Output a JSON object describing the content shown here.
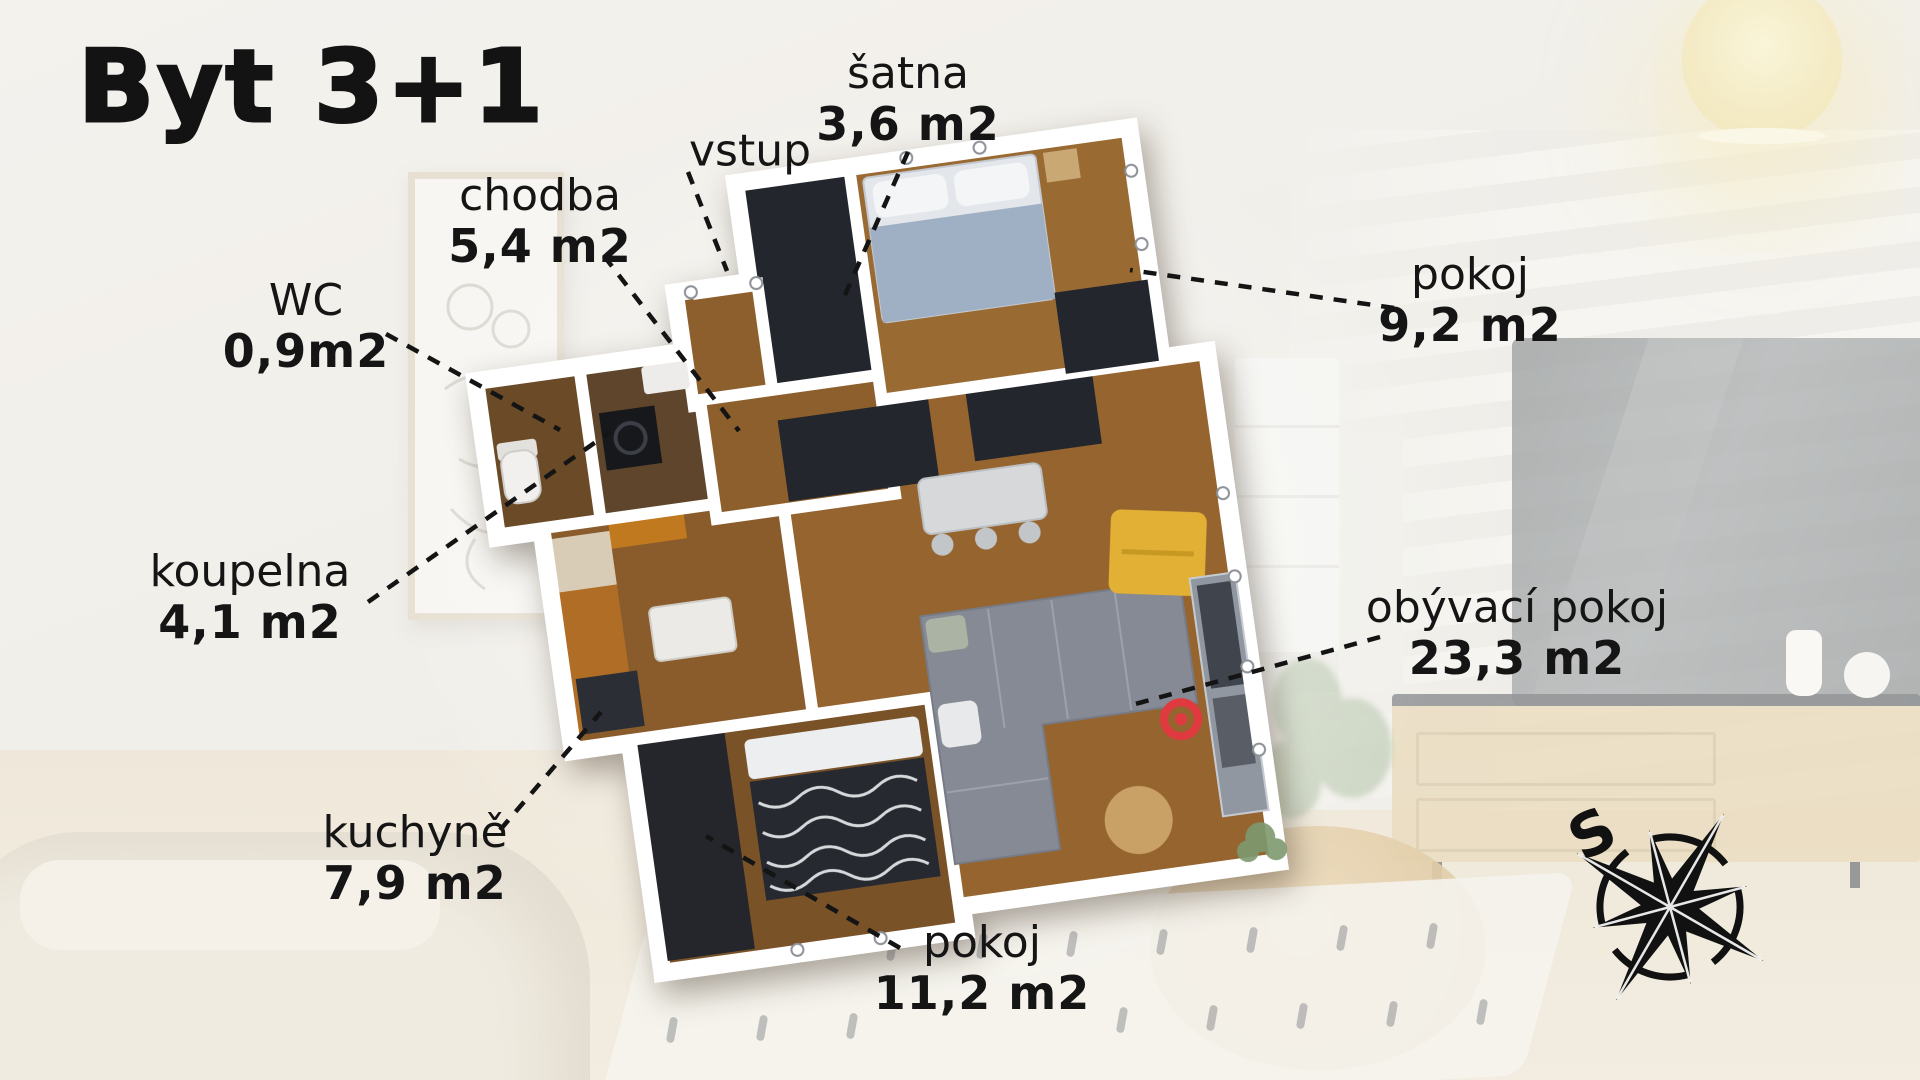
{
  "title": "Byt 3+1",
  "compass": {
    "north_letter": "S"
  },
  "rooms": [
    {
      "name": "šatna",
      "area": "3,6 m2"
    },
    {
      "name": "vstup",
      "area": ""
    },
    {
      "name": "chodba",
      "area": "5,4 m2"
    },
    {
      "name": "WC",
      "area": "0,9m2"
    },
    {
      "name": "pokoj",
      "area": "9,2 m2"
    },
    {
      "name": "koupelna",
      "area": "4,1 m2"
    },
    {
      "name": "obývací pokoj",
      "area": "23,3 m2"
    },
    {
      "name": "kuchyně",
      "area": "7,9 m2"
    },
    {
      "name": "pokoj",
      "area": "11,2 m2"
    }
  ],
  "colors": {
    "label_text": "#151515",
    "floor_wood": "#96652f",
    "dark_fill": "#23262c",
    "wall_white": "#ffffff",
    "sofa_gray": "#868a95",
    "accent_yellow": "#e2b034",
    "marker_red": "#e03a40"
  }
}
